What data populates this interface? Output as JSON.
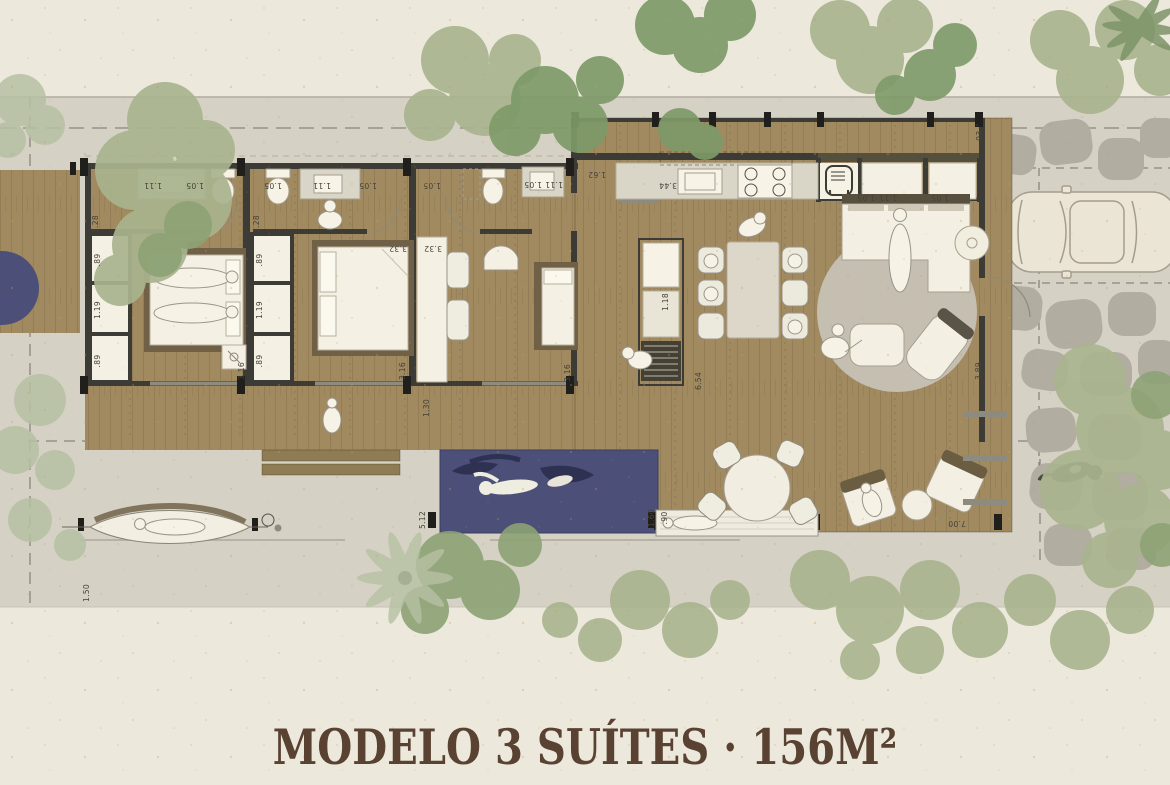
{
  "title": "MODELO 3 SUÍTES · 156M²",
  "dims": [
    "1.11",
    "1.05",
    "1.05",
    "1.11",
    "1.05",
    "1.05",
    "1.05",
    "1.11",
    "1.62",
    "3.44",
    "1.05",
    "1.11",
    "1.05",
    ".93",
    "3.28",
    "3.28",
    ".89",
    "1.19",
    ".89",
    ".89",
    "1.19",
    ".89",
    "3.32",
    "3.32",
    "3.16",
    "3.16",
    "3.16",
    "1.30",
    "1.18",
    "6.54",
    "3.89",
    "5.12",
    "1.60",
    ".90",
    "7.00",
    "1.50"
  ],
  "colors": {
    "paper": "#ece8db",
    "site_band": "#d5d1c4",
    "wood_floor": "#a18a60",
    "wall": "#3c3b35",
    "pool_water": "#4c5078",
    "rug": "#c7c2b5",
    "tree_light": "#a9b48e",
    "tree_dark": "#7e9a69",
    "tree_pale": "#b6c1a3",
    "stone": "#b2ada1",
    "white_furniture": "#f4f0e3",
    "title_text": "#5a4233"
  },
  "icons": {
    "bed-icon": "rect-with-pillows",
    "toilet-icon": "tank-and-oval",
    "sink-icon": "counter-basin",
    "stove-icon": "four-burners",
    "fridge-icon": "rounded-rect-appliance",
    "sofa-icon": "L-shape",
    "dining-table-icon": "rect-six-chairs",
    "pool-swimmer-icon": "swimming-figure",
    "car-icon": "top-view-sedan",
    "dog-icon": "animal-top-view",
    "tree-icon": "canopy-blob",
    "palm-icon": "frond-fan",
    "hammock-icon": "leaf-shape",
    "outdoor-shower-icon": "circle-dot",
    "person-icon": "head-and-shoulders"
  }
}
